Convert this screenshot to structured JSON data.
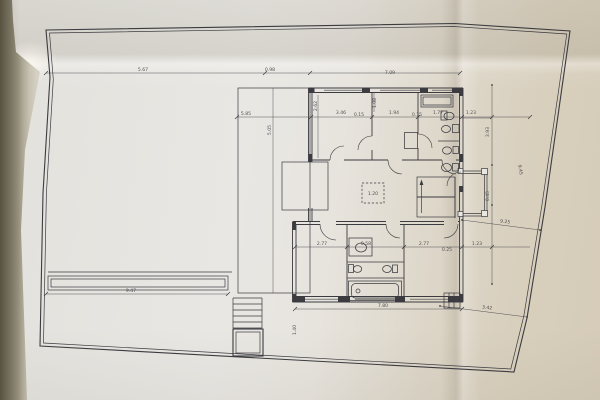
{
  "scene": {
    "colors": {
      "background": "#6f6957",
      "paper": "#e9e7e2",
      "paper_warm": "#d6cdbb",
      "ink": "#3b3b40"
    }
  },
  "plan": {
    "dimension_labels": [
      {
        "text": "5.67",
        "x": 143,
        "y": 71
      },
      {
        "text": "0.98",
        "x": 270,
        "y": 71
      },
      {
        "text": "7.09",
        "x": 390,
        "y": 74
      },
      {
        "text": "5.85",
        "x": 246,
        "y": 115
      },
      {
        "text": "3.46",
        "x": 341,
        "y": 114
      },
      {
        "text": "0.15",
        "x": 359,
        "y": 116
      },
      {
        "text": "1.94",
        "x": 394,
        "y": 114
      },
      {
        "text": "0.15",
        "x": 417,
        "y": 116
      },
      {
        "text": "1.77",
        "x": 438,
        "y": 114
      },
      {
        "text": "1.23",
        "x": 471,
        "y": 114
      },
      {
        "text": "5.05",
        "x": 271,
        "y": 130,
        "r": -90
      },
      {
        "text": "2.62",
        "x": 317,
        "y": 106,
        "r": -90
      },
      {
        "text": "1.08",
        "x": 376,
        "y": 103,
        "r": -90
      },
      {
        "text": "1.20",
        "x": 373,
        "y": 195
      },
      {
        "text": "2.77",
        "x": 322,
        "y": 245
      },
      {
        "text": "0.58",
        "x": 366,
        "y": 245
      },
      {
        "text": "2.77",
        "x": 424,
        "y": 245
      },
      {
        "text": "0.25",
        "x": 447,
        "y": 251
      },
      {
        "text": "1.23",
        "x": 477,
        "y": 245
      },
      {
        "text": "3.93",
        "x": 489,
        "y": 132,
        "r": -90
      },
      {
        "text": "0.45",
        "x": 489,
        "y": 196,
        "r": -90
      },
      {
        "text": "9.45",
        "x": 519,
        "y": 170,
        "r": 80
      },
      {
        "text": "9.25",
        "x": 505,
        "y": 223,
        "r": 7
      },
      {
        "text": "3.42",
        "x": 487,
        "y": 309,
        "r": 7
      },
      {
        "text": "7.80",
        "x": 383,
        "y": 307
      },
      {
        "text": "9.47",
        "x": 131,
        "y": 292
      },
      {
        "text": "1.40",
        "x": 296,
        "y": 330,
        "r": -90
      }
    ]
  }
}
